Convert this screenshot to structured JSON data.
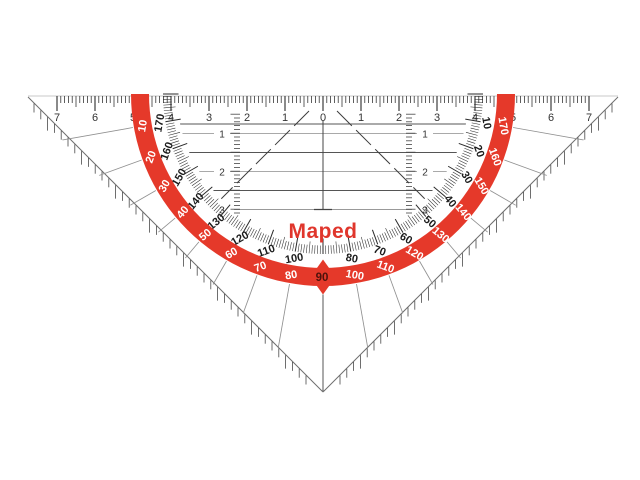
{
  "brand": {
    "name": "Maped",
    "logo_color": "#e0362c"
  },
  "top_ruler": {
    "numbers": [
      "7",
      "6",
      "5",
      "4",
      "3",
      "2",
      "1",
      "0",
      "1",
      "2",
      "3",
      "4",
      "5",
      "6",
      "7"
    ]
  },
  "vertical_scales": {
    "left_labels": [
      "1",
      "2",
      "3"
    ],
    "right_labels": [
      "1",
      "2",
      "3"
    ]
  },
  "protractor": {
    "band_color": "#e5392a",
    "inner_scale_labels": [
      "170",
      "160",
      "150",
      "140",
      "130",
      "120",
      "110",
      "100",
      "80",
      "70",
      "60",
      "50",
      "40",
      "30",
      "20",
      "10"
    ],
    "outer_scale_labels": [
      "10",
      "20",
      "30",
      "40",
      "50",
      "60",
      "70",
      "80",
      "100",
      "110",
      "120",
      "130",
      "140",
      "150",
      "160",
      "170"
    ],
    "pointer_label": "90",
    "pointer_label_color": "#4d120b"
  },
  "colors": {
    "ink": "#2a2a2a",
    "number_ink": "#333333",
    "line_dark": "#555555",
    "line_light": "#a9a9a9",
    "radial_line": "#909090",
    "edge_line": "#6e6e6e",
    "top_edge_line": "#c9c9c9",
    "background": "#ffffff"
  }
}
